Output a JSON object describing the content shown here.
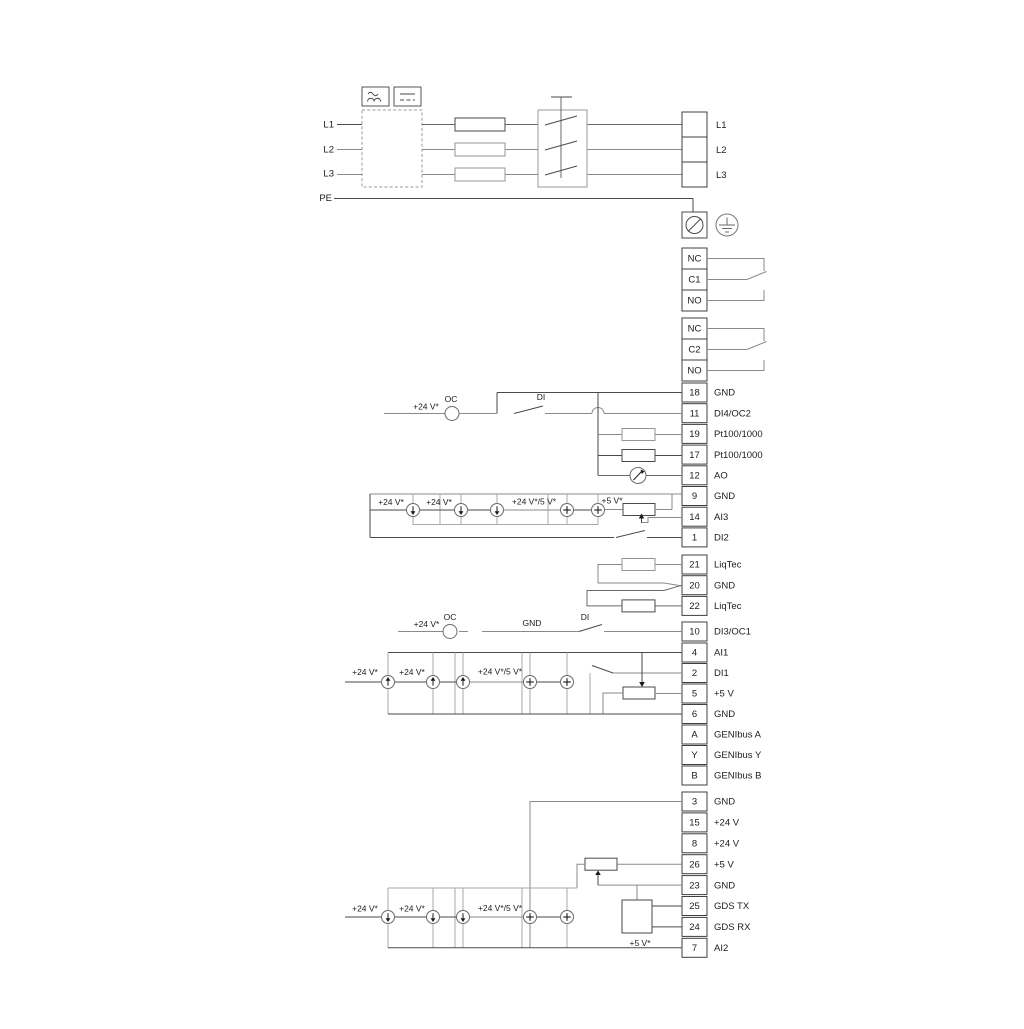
{
  "power": {
    "inputs": [
      "L1",
      "L2",
      "L3"
    ],
    "pe_label": "PE",
    "outputs": [
      "L1",
      "L2",
      "L3"
    ]
  },
  "relays": [
    {
      "cells": [
        "NC",
        "C1",
        "NO"
      ]
    },
    {
      "cells": [
        "NC",
        "C2",
        "NO"
      ]
    }
  ],
  "terminal_strips": {
    "io_top": [
      {
        "num": "18",
        "label": "GND"
      },
      {
        "num": "11",
        "label": "DI4/OC2"
      },
      {
        "num": "19",
        "label": "Pt100/1000"
      },
      {
        "num": "17",
        "label": "Pt100/1000"
      },
      {
        "num": "12",
        "label": "AO"
      },
      {
        "num": "9",
        "label": "GND"
      },
      {
        "num": "14",
        "label": "AI3"
      },
      {
        "num": "1",
        "label": "DI2"
      }
    ],
    "liqtec": [
      {
        "num": "21",
        "label": "LiqTec"
      },
      {
        "num": "20",
        "label": "GND"
      },
      {
        "num": "22",
        "label": "LiqTec"
      }
    ],
    "di3": [
      {
        "num": "10",
        "label": "DI3/OC1"
      }
    ],
    "io_mid": [
      {
        "num": "4",
        "label": "AI1"
      },
      {
        "num": "2",
        "label": "DI1"
      },
      {
        "num": "5",
        "label": "+5 V"
      },
      {
        "num": "6",
        "label": "GND"
      },
      {
        "num": "A",
        "label": "GENIbus A"
      },
      {
        "num": "Y",
        "label": "GENIbus Y"
      },
      {
        "num": "B",
        "label": "GENIbus B"
      }
    ],
    "io_bottom": [
      {
        "num": "3",
        "label": "GND"
      },
      {
        "num": "15",
        "label": "+24 V"
      },
      {
        "num": "8",
        "label": "+24 V"
      },
      {
        "num": "26",
        "label": "+5 V"
      },
      {
        "num": "23",
        "label": "GND"
      },
      {
        "num": "25",
        "label": "GDS TX"
      },
      {
        "num": "24",
        "label": "GDS RX"
      },
      {
        "num": "7",
        "label": "AI2"
      }
    ]
  },
  "annotations": {
    "v24": "+24 V*",
    "v24_5": "+24 V*/5 V*",
    "v5": "+5 V*",
    "oc": "OC",
    "di": "DI",
    "gnd": "GND"
  },
  "icons": {
    "ac": "ac-wave-icon",
    "dc": "dc-icon",
    "pe_terminal": "protective-earth-terminal-icon",
    "earth": "earth-ground-icon",
    "meter": "analog-output-meter-icon"
  },
  "colors": {
    "wire_dark": "#4a4a4a",
    "wire_gray": "#8a8a8a",
    "text": "#1c1c1c",
    "background": "#ffffff"
  }
}
